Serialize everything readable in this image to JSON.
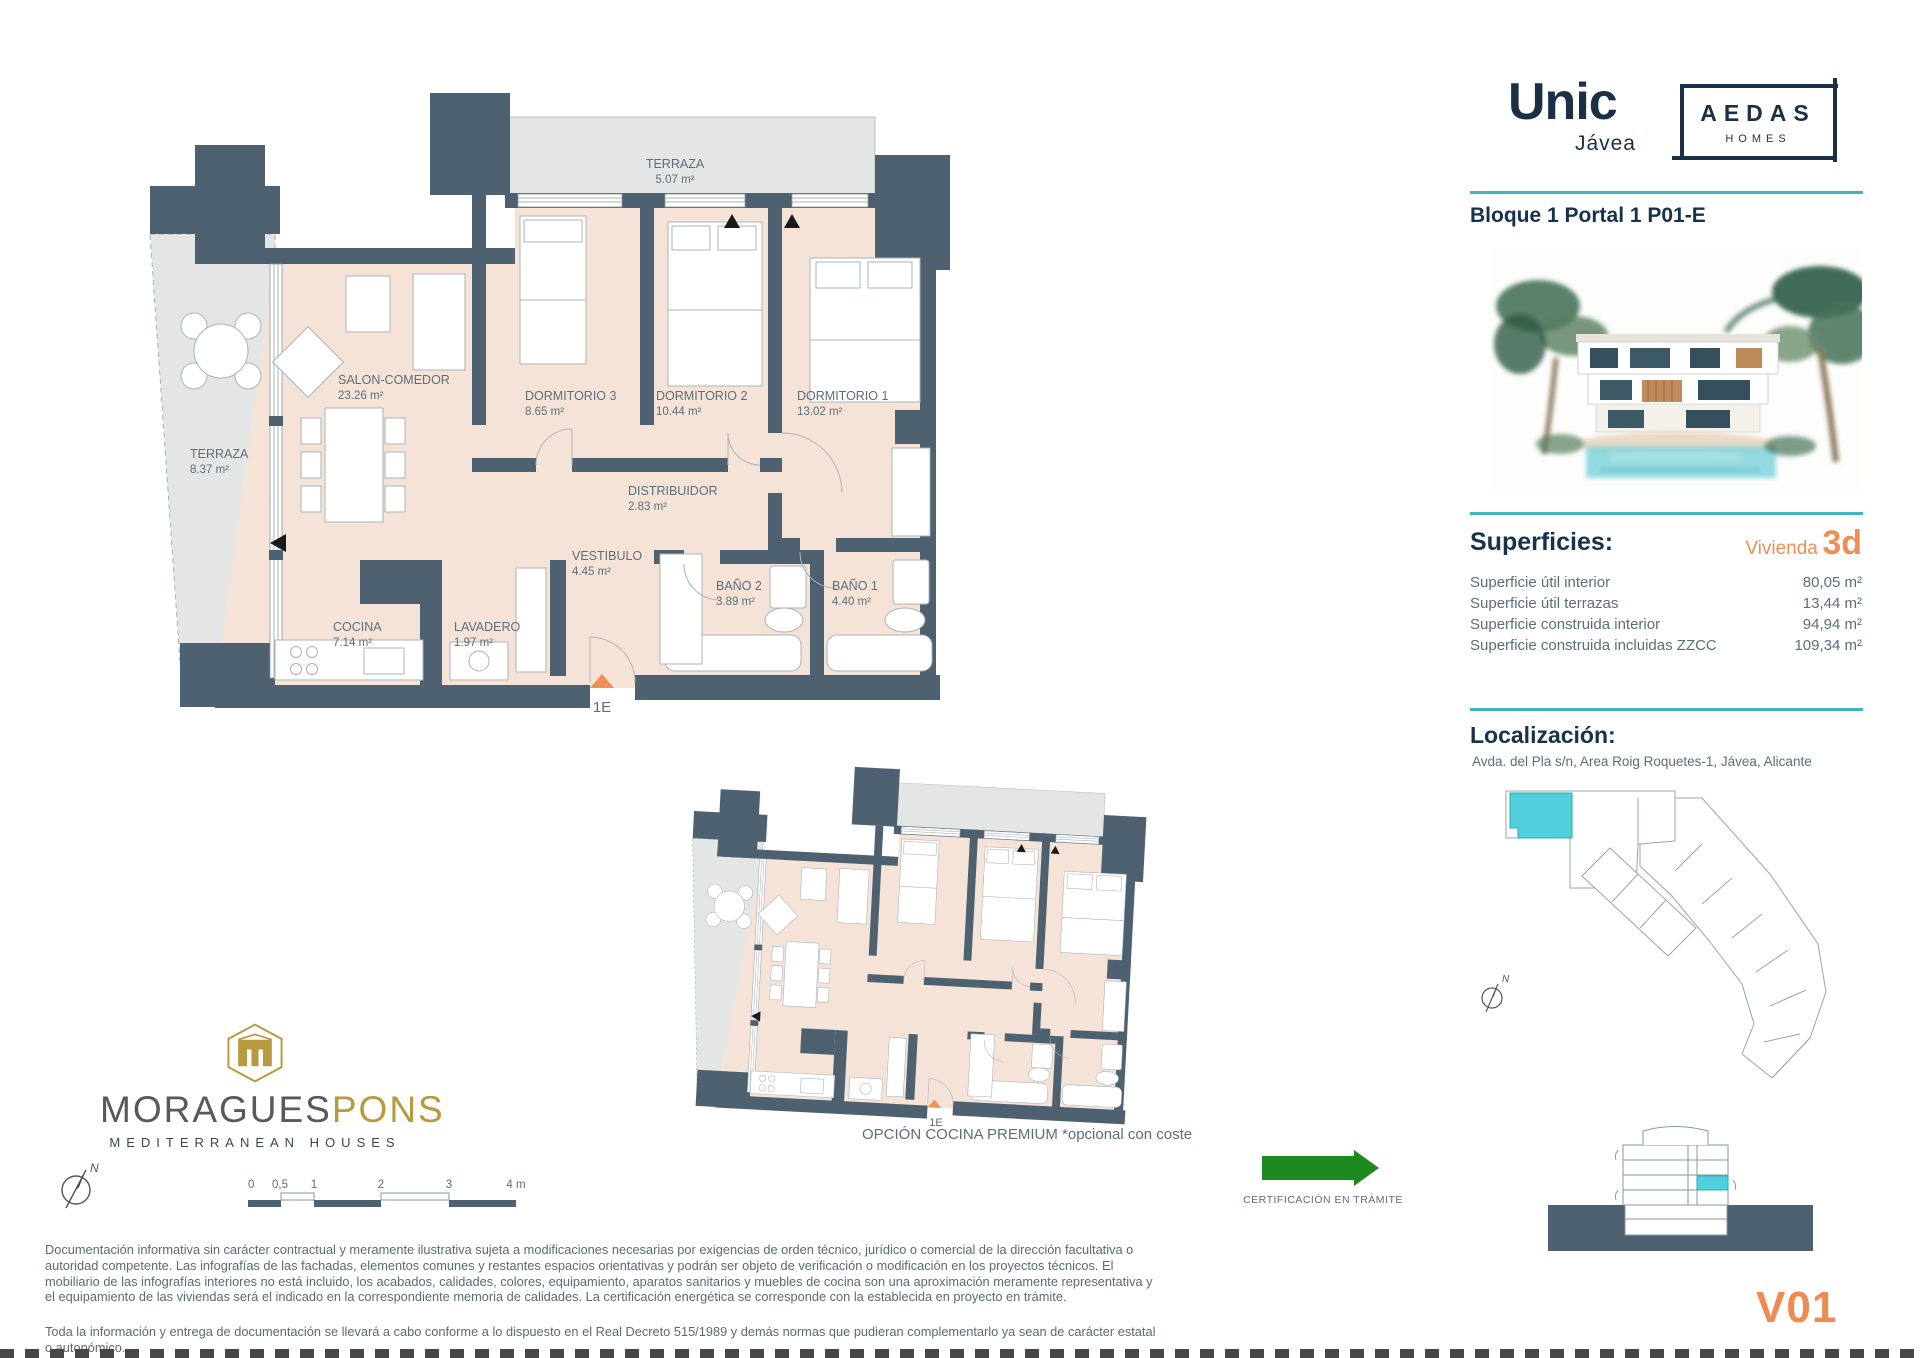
{
  "header": {
    "project_name": "Unic",
    "project_city": "Jávea",
    "brand_name": "AEDAS",
    "brand_sub": "HOMES",
    "unit_title": "Bloque 1 Portal 1 P01-E"
  },
  "superficies": {
    "heading": "Superficies:",
    "vivienda_label": "Vivienda",
    "vivienda_code": "3d",
    "rows": [
      {
        "label": "Superficie útil interior",
        "value": "80,05 m²"
      },
      {
        "label": "Superficie útil terrazas",
        "value": "13,44 m²"
      },
      {
        "label": "Superficie construida interior",
        "value": "94,94 m²"
      },
      {
        "label": "Superficie construida incluidas ZZCC",
        "value": "109,34 m²"
      }
    ]
  },
  "localizacion": {
    "heading": "Localización:",
    "address": "Avda. del Pla s/n, Area Roig Roquetes-1, Jávea, Alicante"
  },
  "plan": {
    "rooms": [
      {
        "name": "TERRAZA",
        "area": "5.07 m²"
      },
      {
        "name": "SALON-COMEDOR",
        "area": "23.26 m²"
      },
      {
        "name": "DORMITORIO 3",
        "area": "8.65 m²"
      },
      {
        "name": "DORMITORIO 2",
        "area": "10.44 m²"
      },
      {
        "name": "DORMITORIO 1",
        "area": "13.02 m²"
      },
      {
        "name": "DISTRIBUIDOR",
        "area": "2.83 m²"
      },
      {
        "name": "TERRAZA",
        "area": "8.37 m²"
      },
      {
        "name": "VESTIBULO",
        "area": "4.45 m²"
      },
      {
        "name": "BAÑO 2",
        "area": "3.89 m²"
      },
      {
        "name": "BAÑO 1",
        "area": "4.40 m²"
      },
      {
        "name": "COCINA",
        "area": "7.14 m²"
      },
      {
        "name": "LAVADERO",
        "area": "1.97 m²"
      }
    ],
    "entrance_label": "1E",
    "premium_caption": "OPCIÓN COCINA PREMIUM *opcional con coste"
  },
  "site": {
    "north_label": "N"
  },
  "footer": {
    "logo": {
      "part1": "MORAGUES",
      "part2": "PONS",
      "tagline": "MEDITERRANEAN HOUSES"
    },
    "compass_label": "N",
    "scale_labels": [
      "0",
      "0,5",
      "1",
      "2",
      "3",
      "4 m"
    ],
    "certification": "CERTIFICACIÓN EN TRÁMITE",
    "disclaimer_1": "Documentación informativa sin carácter contractual y meramente ilustrativa sujeta a modificaciones necesarias por exigencias de orden técnico, jurídico o comercial de la dirección facultativa o autoridad competente. Las infografías de las fachadas, elementos comunes y restantes espacios orientativas y podrán ser objeto de verificación o modificación en los proyectos técnicos. El mobiliario de las infografías interiores no está incluido, los acabados, calidades, colores, equipamiento, aparatos sanitarios y muebles de cocina son una aproximación meramente representativa y el equipamiento de las viviendas será el indicado en la correspondiente memoria de calidades. La certificación energética se corresponde con la establecida en proyecto en trámite.",
    "disclaimer_2": "Toda la información y entrega de documentación se llevará a cabo conforme a lo dispuesto en el Real Decreto 515/1989 y demás normas que pudieran complementarlo ya sean de carácter estatal o autonómico.",
    "version": "V01"
  },
  "colors": {
    "teal": "#3db6c2",
    "orange": "#ef8e55",
    "wall": "#4d6170",
    "floor": "#f6e3d8",
    "terrace": "#e4e6e5",
    "heading": "#16324c",
    "body_text": "#5d6e79",
    "green": "#1d8a1f",
    "gold": "#b79a3e",
    "highlight": "#4fd0da"
  }
}
